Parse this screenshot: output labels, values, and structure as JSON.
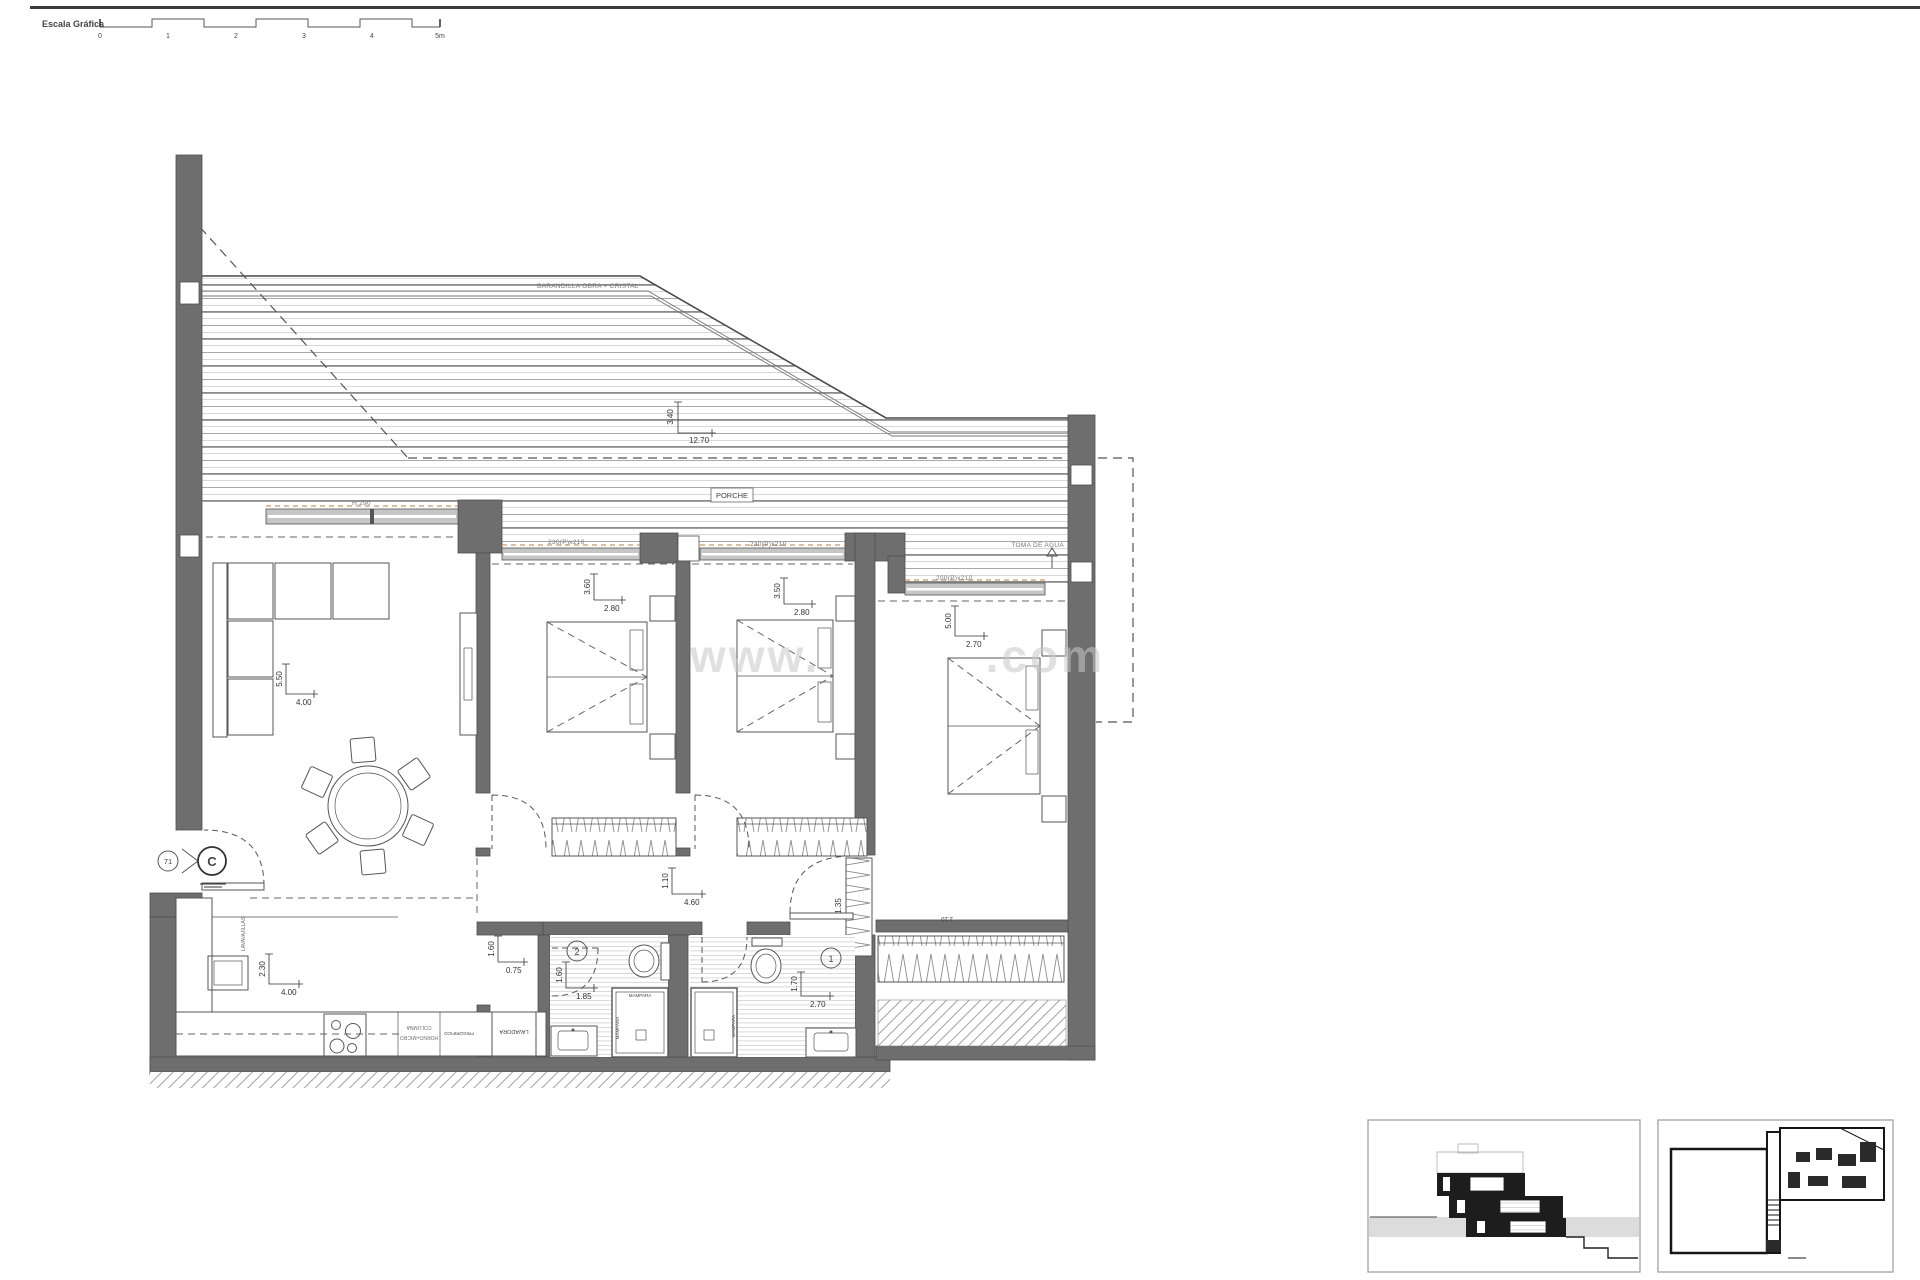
{
  "scale_bar": {
    "label": "Escala Gráfica",
    "ticks": [
      "0",
      "1",
      "2",
      "3",
      "4",
      "5m"
    ]
  },
  "watermark": {
    "prefix": "www.",
    "suffix": ".com"
  },
  "terrace": {
    "railing_label": "BARANDILLA OBRA + CRISTAL",
    "porch_label": "PORCHE",
    "depth": "3.40",
    "width": "12.70",
    "water_tap_label": "TOMA DE AGUA"
  },
  "windows": {
    "living_height": "H:290",
    "bedroom1": "230(P)x210",
    "bedroom2": "230(P)x210",
    "master": "200(P)x210"
  },
  "rooms": {
    "living": {
      "depth": "5.50",
      "width": "4.00"
    },
    "bedroom1": {
      "depth": "3.60",
      "width": "2.80"
    },
    "bedroom2": {
      "depth": "3.50",
      "width": "2.80"
    },
    "master": {
      "depth": "5.00",
      "width": "2.70"
    },
    "hall": {
      "depth": "1.10",
      "width": "4.60"
    },
    "kitchen": {
      "depth": "2.30",
      "width": "4.00"
    },
    "laundry": {
      "depth": "1.60",
      "width": "0.75",
      "appliance": "LAVADORA"
    },
    "bath2": {
      "number": "2",
      "depth": "1.60",
      "width": "1.85",
      "screen": "MAMPARA"
    },
    "bath1": {
      "number": "1",
      "depth": "1.70",
      "width": "2.70",
      "screen": "MAMPARA"
    },
    "master_closet": {
      "depth": "1.35",
      "width": "2.10"
    }
  },
  "kitchen_units": {
    "dishwasher": "LAVAVAJILLAS",
    "column_l1": "COLUMNA",
    "column_l2": "HORNO+MICRO",
    "fridge": "FRIGORIFICO"
  },
  "section_marker": {
    "number": "71",
    "letter": "C"
  },
  "colors": {
    "wall": "#6e6e6e",
    "line": "#4f4f4f",
    "sill_accent": "#c79b68",
    "watermark": "#c8c8c8",
    "ground_band": "#dcdcdc"
  }
}
